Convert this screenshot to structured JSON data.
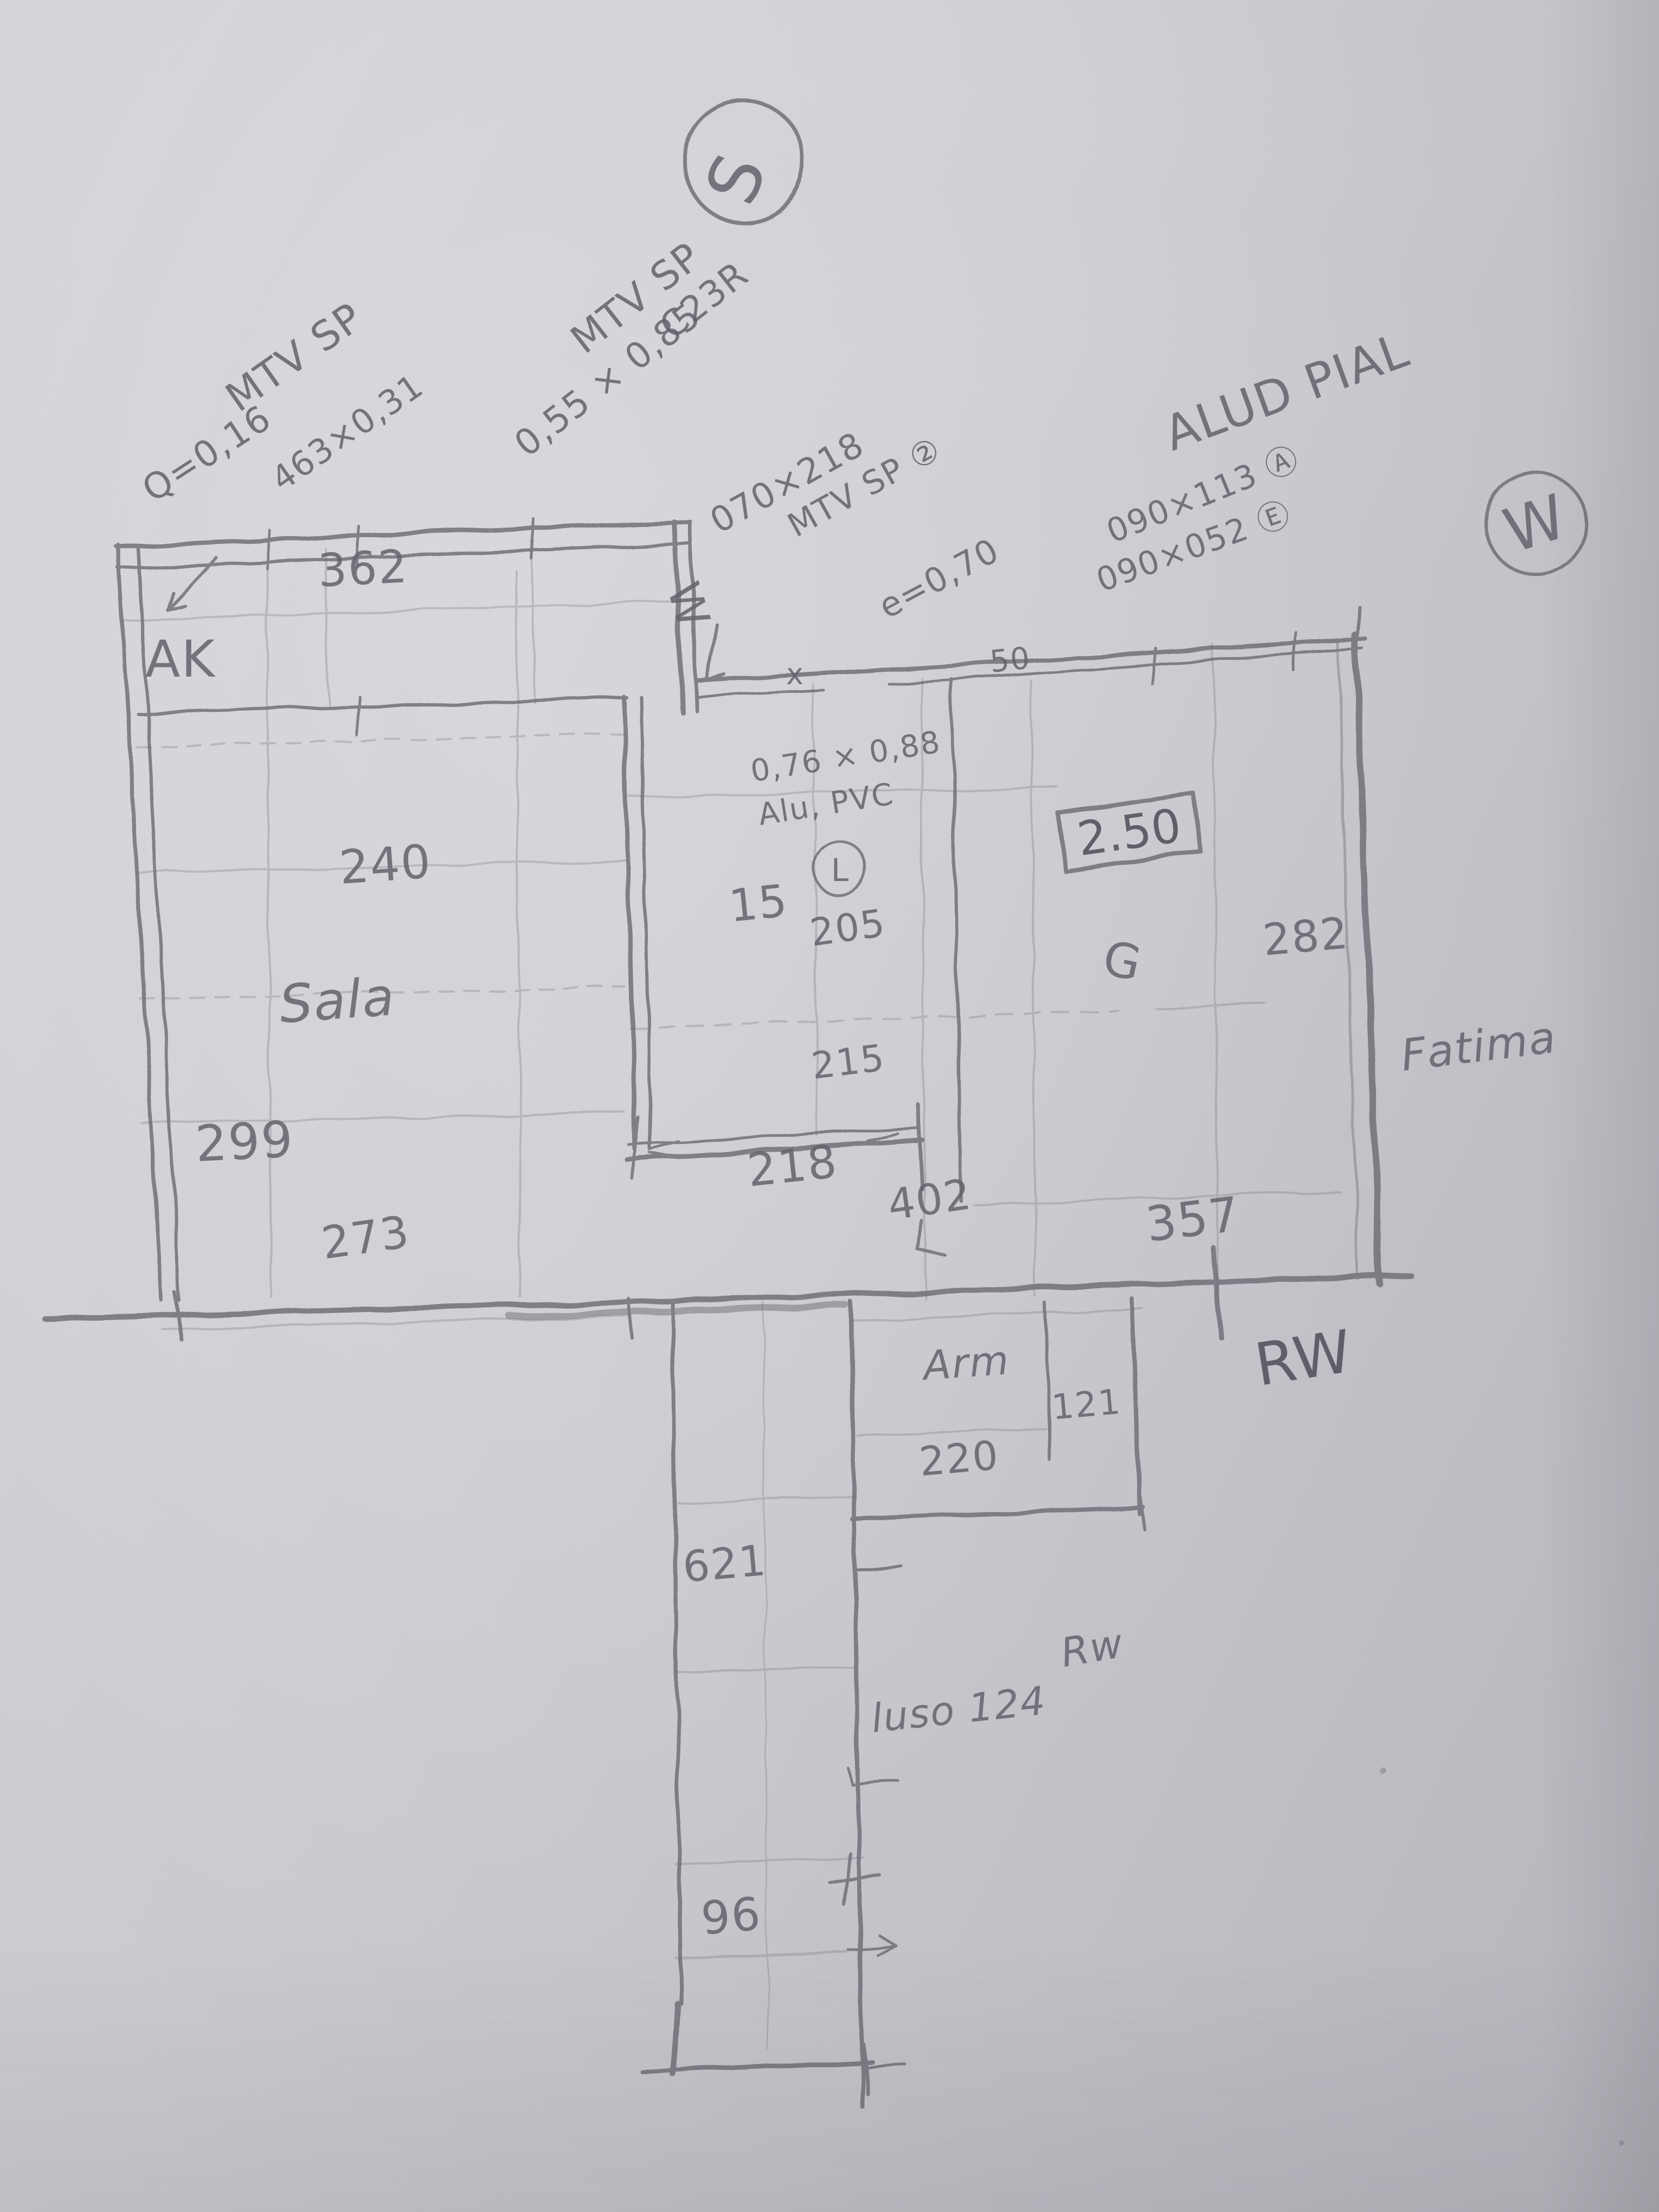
{
  "palette": {
    "paper": "#cac9cf",
    "pencil": "#6e6d75"
  },
  "compass": {
    "south": "S",
    "west": "W"
  },
  "notes": {
    "mtv_left": {
      "l1": "MTV SP",
      "l2": "463×0,31",
      "l3": "Q=0,16"
    },
    "mtv_mid": {
      "l1": "MTV SP",
      "l2": "0,55 × 0,85",
      "l3": "C23R"
    },
    "door_mid": {
      "l1": "070×218",
      "l2": "MTV SP ②",
      "l3": "e=0,70"
    },
    "alu_right": {
      "title": "ALUD PIAL",
      "l1": "090×113 Ⓐ",
      "l2": "090×052 Ⓔ"
    },
    "window_mid": {
      "l1": "0,76 × 0,88",
      "l2": "Alu, PVC",
      "badge": "L"
    },
    "wall_marks": {
      "x": "x",
      "fifty": "50"
    }
  },
  "rooms": {
    "sala": "Sala",
    "closet": "Arm",
    "fatima": "Fatima",
    "ak": "AK",
    "window_w": "W",
    "g_mark": "G",
    "rw_right": "RW",
    "rw_lower": "Rw",
    "leader_lower": "luso 124"
  },
  "dims": {
    "d362": "362",
    "d240": "240",
    "d299": "299",
    "d273": "273",
    "d15": "15",
    "d205": "205",
    "d215": "215",
    "d218": "218",
    "d402": "402",
    "d357": "357",
    "d282": "282",
    "d220": "220",
    "d121": "121",
    "d621": "621",
    "d96": "96",
    "height_box": "2.50"
  }
}
